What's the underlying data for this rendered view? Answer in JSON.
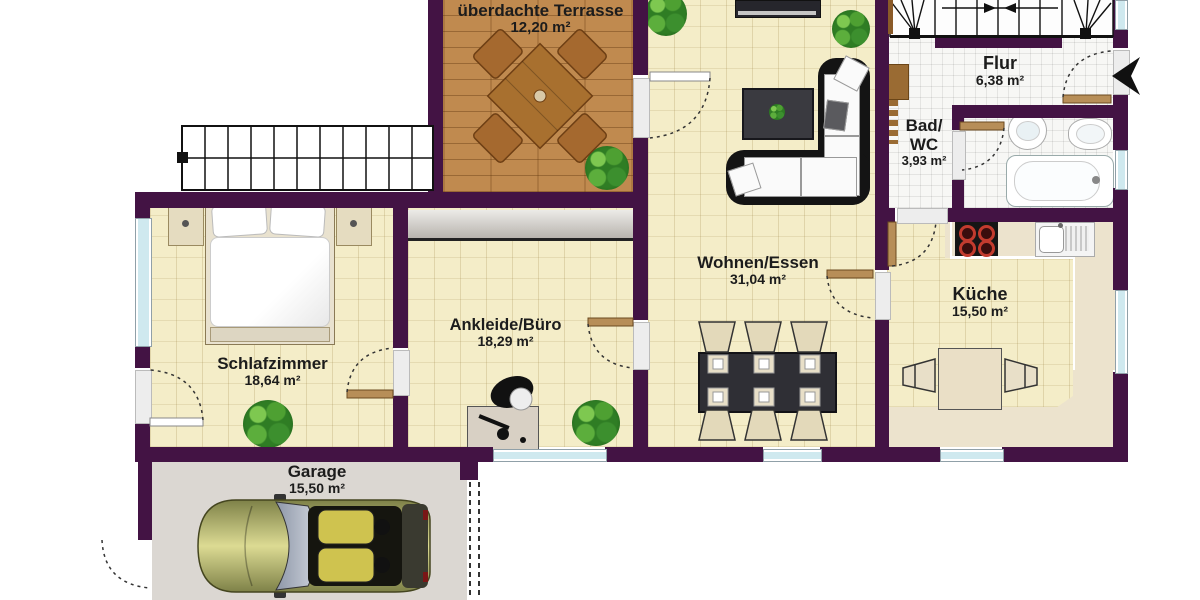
{
  "rooms": {
    "terrasse": {
      "name": "überdachte Terrasse",
      "area": "12,20 m²"
    },
    "flur": {
      "name": "Flur",
      "area": "6,38 m²"
    },
    "bad": {
      "line1": "Bad/",
      "line2": "WC",
      "area": "3,93 m²"
    },
    "wohnen": {
      "name": "Wohnen/Essen",
      "area": "31,04 m²"
    },
    "kueche": {
      "name": "Küche",
      "area": "15,50 m²"
    },
    "ankleide": {
      "name": "Ankleide/Büro",
      "area": "18,29 m²"
    },
    "schlafzimmer": {
      "name": "Schlafzimmer",
      "area": "18,64 m²"
    },
    "garage": {
      "name": "Garage",
      "area": "15,50 m²"
    }
  },
  "colors": {
    "wall": "#431344",
    "floor_tile": "#f4edc8",
    "terrace_wood": "#c08a4f",
    "white_tile": "#f7f7f5",
    "garage_floor": "#dbd7d2",
    "window_glass": "#cfe9ef",
    "door_wood": "#b78e58",
    "plant_green": "#2f7d24",
    "label_text": "#1c1c1c"
  }
}
